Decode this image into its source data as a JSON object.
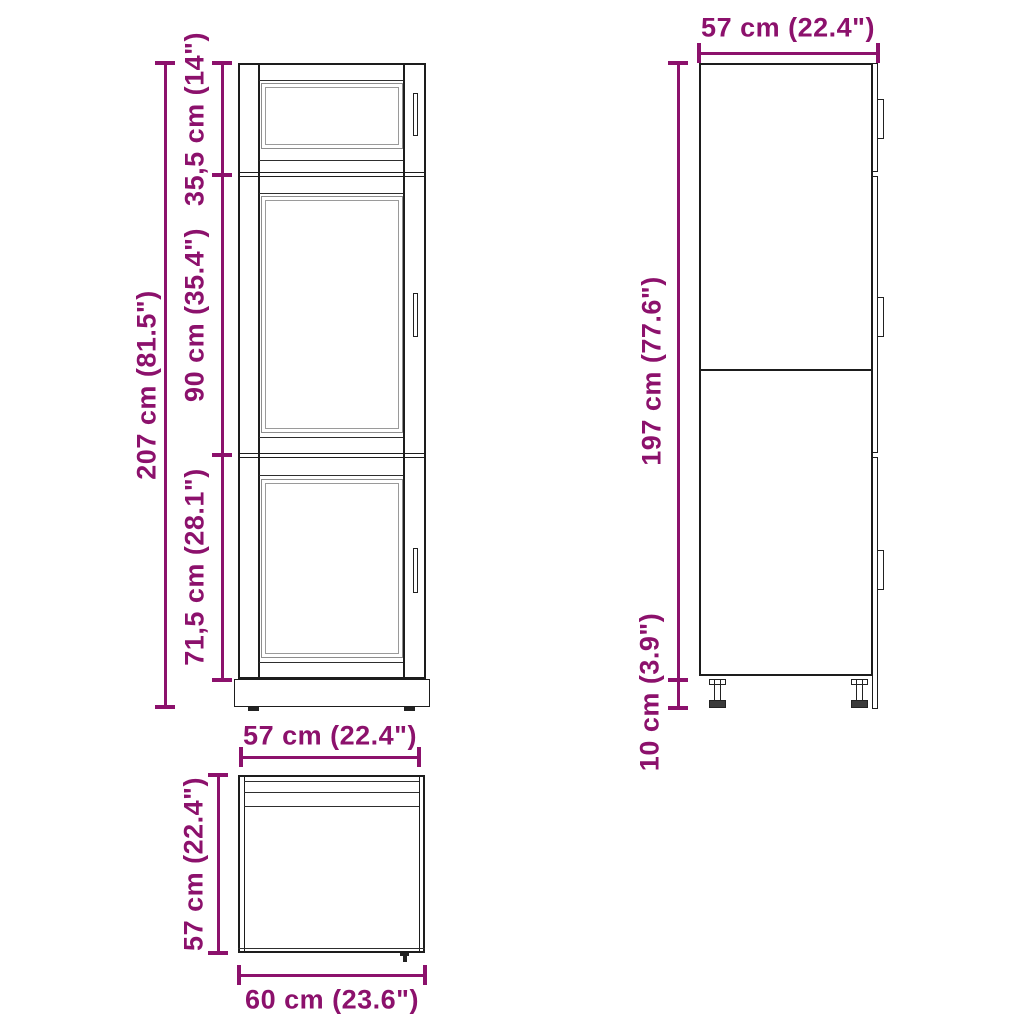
{
  "colors": {
    "accent": "#8C116C",
    "line": "#1d1d1d",
    "panel_line": "#8d8d8d",
    "background": "#ffffff"
  },
  "views": {
    "front": "front-view",
    "side": "side-view",
    "top": "top-view"
  },
  "dims": {
    "front_total_height": "207 cm (81.5\")",
    "front_top_section_height": "35,5 cm (14\")",
    "front_middle_section_height": "90 cm (35.4\")",
    "front_bottom_section_height": "71,5 cm (28.1\")",
    "side_depth": "57 cm (22.4\")",
    "side_body_height": "197 cm (77.6\")",
    "side_leg_height": "10 cm (3.9\")",
    "top_width": "57 cm (22.4\")",
    "top_depth": "57 cm (22.4\")",
    "top_base_width": "60 cm (23.6\")"
  }
}
